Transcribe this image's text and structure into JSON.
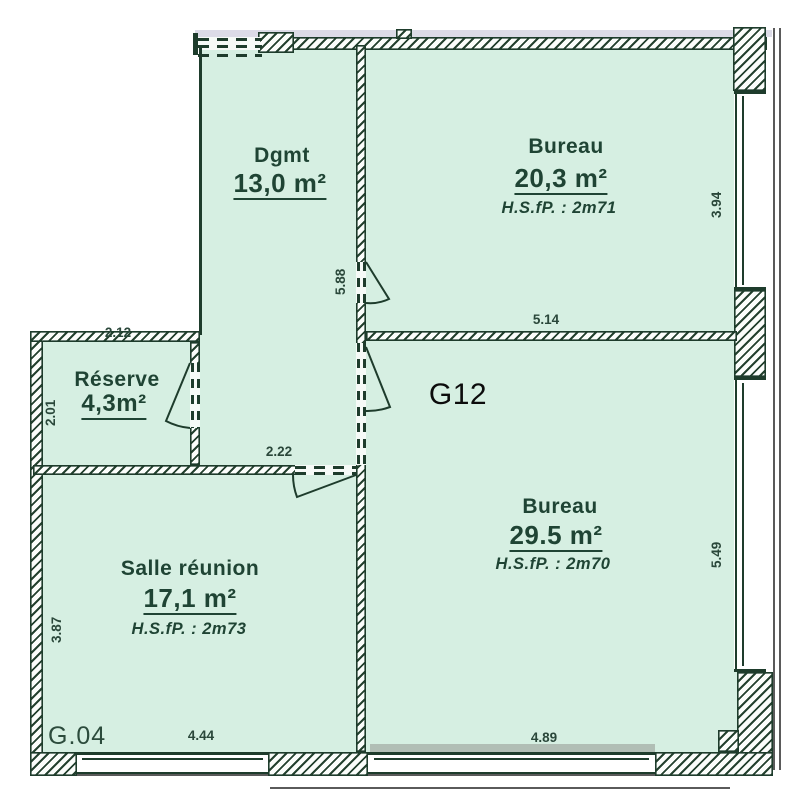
{
  "plan": {
    "unit_label": "G12",
    "zone_label": "G.04",
    "rooms": [
      {
        "name": "Dgmt",
        "area": "13,0 m²"
      },
      {
        "name": "Bureau",
        "area": "20,3 m²",
        "ceiling": "H.S.fP. : 2m71"
      },
      {
        "name": "Réserve",
        "area": "4,3m²"
      },
      {
        "name": "Salle réunion",
        "area": "17,1 m²",
        "ceiling": "H.S.fP. : 2m73"
      },
      {
        "name": "Bureau",
        "area": "29.5 m²",
        "ceiling": "H.S.fP. : 2m70"
      }
    ],
    "dims": {
      "d212": "2.12",
      "d201": "2.01",
      "d588": "5.88",
      "d514": "5.14",
      "d394": "3.94",
      "d222": "2.22",
      "d387": "3.87",
      "d444": "4.44",
      "d489": "4.89",
      "d549": "5.49"
    },
    "colors": {
      "room_fill": "#d6efe2",
      "wall_line": "#1e3c2c",
      "label_text": "#1f4434",
      "annotation_text": "#0c0c0c"
    }
  }
}
